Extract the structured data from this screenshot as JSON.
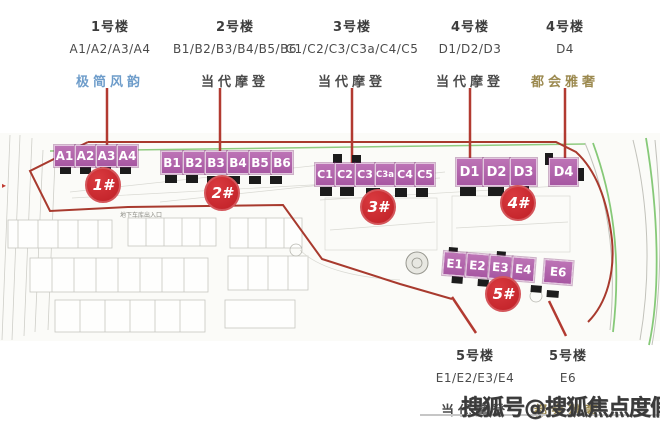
{
  "legend": {
    "columns": [
      {
        "building": "1号楼",
        "units": "A1/A2/A3/A4",
        "style": "极简风韵",
        "style_color": "#6d9cca"
      },
      {
        "building": "2号楼",
        "units": "B1/B2/B3/B4/B5/B6",
        "style": "当代摩登",
        "style_color": "#4a4a4a"
      },
      {
        "building": "3号楼",
        "units": "C1/C2/C3/C3a/C4/C5",
        "style": "当代摩登",
        "style_color": "#4a4a4a"
      },
      {
        "building": "4号楼",
        "units": "D1/D2/D3",
        "style": "当代摩登",
        "style_color": "#4a4a4a"
      },
      {
        "building": "4号楼",
        "units": "D4",
        "style": "都会雅奢",
        "style_color": "#9c8a50"
      }
    ]
  },
  "map": {
    "rows": [
      {
        "badge": "1#",
        "cells": [
          "A1",
          "A2",
          "A3",
          "A4"
        ]
      },
      {
        "badge": "2#",
        "cells": [
          "B1",
          "B2",
          "B3",
          "B4",
          "B5",
          "B6"
        ]
      },
      {
        "badge": "3#",
        "cells": [
          "C1",
          "C2",
          "C3",
          "C3a",
          "C4",
          "C5"
        ]
      },
      {
        "badge": "4#",
        "cells": [
          "D1",
          "D2",
          "D3",
          "D4"
        ]
      },
      {
        "badge": "5#",
        "cells": [
          "E1",
          "E2",
          "E3",
          "E4",
          "E6"
        ]
      }
    ],
    "underground_label": "地下车库出入口",
    "colors": {
      "unit_block": "#b164ab",
      "badge": "#c4232a",
      "boundary_red": "#a83a2e",
      "road_green": "#86c978",
      "footprint_black": "#1c1c1c"
    }
  },
  "footer": {
    "columns": [
      {
        "building": "5号楼",
        "units": "E1/E2/E3/E4",
        "style": "当代摩登",
        "style_color": "#4a4a4a"
      },
      {
        "building": "5号楼",
        "units": "E6",
        "style": "都会雅奢",
        "style_color": "#9c8a50"
      }
    ]
  },
  "watermark": "搜狐号@搜狐焦点度假站"
}
